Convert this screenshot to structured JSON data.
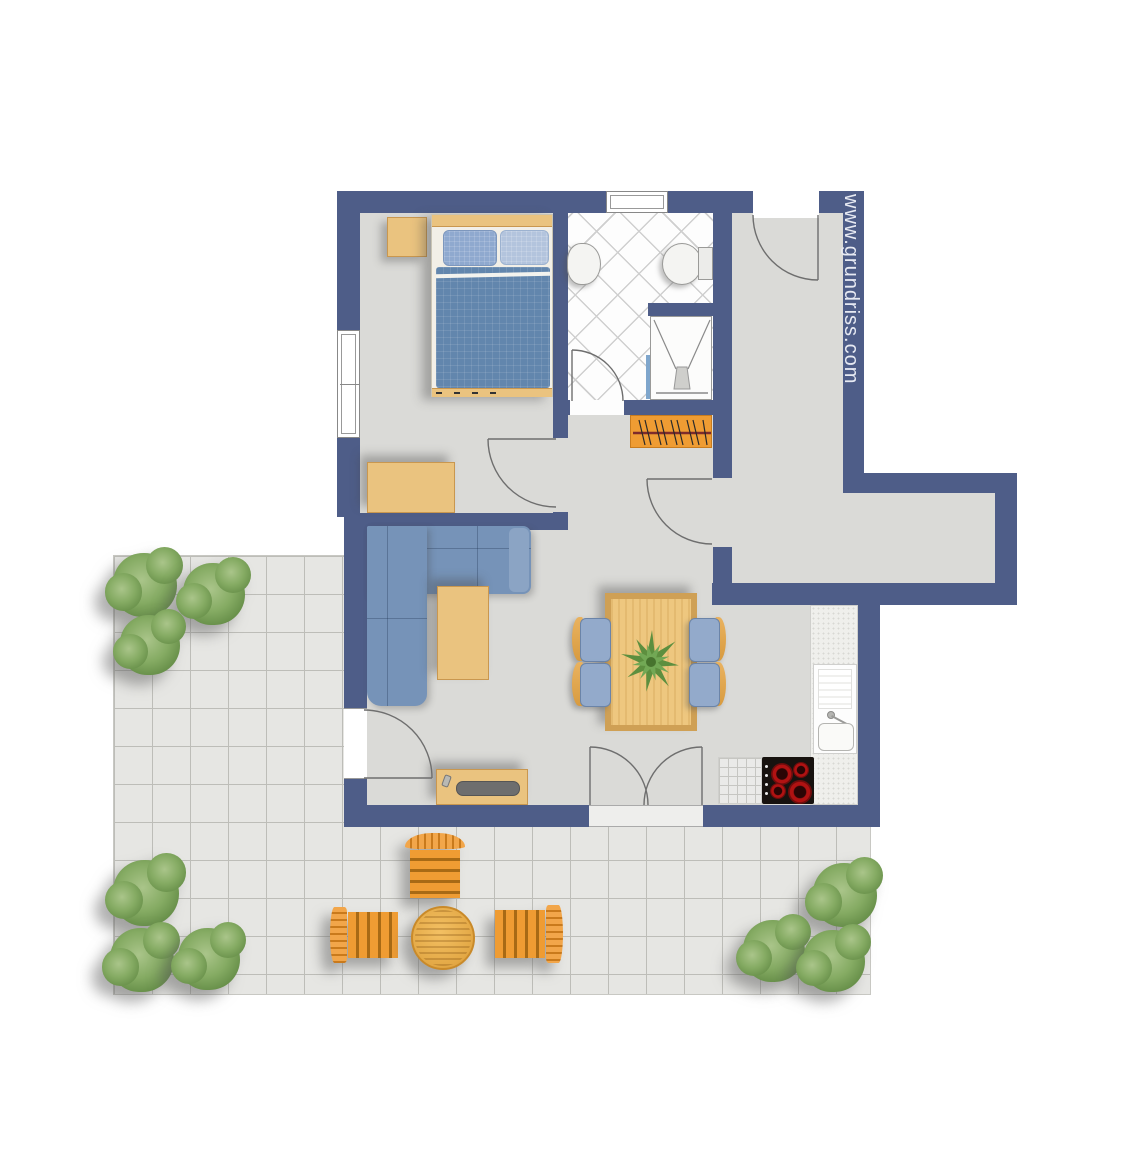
{
  "watermark": {
    "text": "www.grundriss.com"
  },
  "palette": {
    "wall": "#4e5d88",
    "floor": "#dadad7",
    "terrace_tile": "#e6e6e3",
    "tile_line": "#bdbdb8",
    "wood": "#eac37f",
    "wood_dark": "#c9974f",
    "table_wood": "#eec77f",
    "table_border": "#cfa055",
    "sofa": "#7693b8",
    "sofa_light": "#8ba4c4",
    "bed_blanket": "#6286ad",
    "pillow_dark": "#8fa9cf",
    "pillow_light": "#b3c4dd",
    "chair_seat": "#93aacb",
    "chair_back": "#e9b25f",
    "orange": "#ef9c33",
    "bush_green": "#7ba05b",
    "plant_green": "#5d8f3f",
    "cooktop": "#17120f",
    "burner": "#b01212",
    "glass": "#7fa6cc",
    "watermark_color": "#e7eaf3"
  },
  "rooms": [
    "bedroom",
    "bathroom",
    "hall",
    "corridor",
    "living-dining",
    "kitchen",
    "terrace"
  ],
  "furniture": [
    "double-bed",
    "nightstand",
    "dresser",
    "wardrobe",
    "washbasin",
    "toilet",
    "shower",
    "corner-sofa",
    "coffee-table",
    "tv-board",
    "dining-table",
    "dining-chairs",
    "kitchen-sink",
    "cooktop",
    "terrace-table",
    "terrace-chairs",
    "bushes"
  ],
  "dining": {
    "chairs": [
      {
        "x": 572,
        "y": 617,
        "side": "side-left"
      },
      {
        "x": 572,
        "y": 662,
        "side": "side-left"
      },
      {
        "x": 690,
        "y": 617,
        "side": "side-right"
      },
      {
        "x": 690,
        "y": 662,
        "side": "side-right"
      }
    ]
  },
  "terrace": {
    "bushes": [
      {
        "x": 113,
        "y": 553,
        "d": 64
      },
      {
        "x": 183,
        "y": 563,
        "d": 62
      },
      {
        "x": 120,
        "y": 615,
        "d": 60
      },
      {
        "x": 113,
        "y": 860,
        "d": 66
      },
      {
        "x": 110,
        "y": 928,
        "d": 64
      },
      {
        "x": 178,
        "y": 928,
        "d": 62
      },
      {
        "x": 813,
        "y": 863,
        "d": 64
      },
      {
        "x": 743,
        "y": 920,
        "d": 62
      },
      {
        "x": 803,
        "y": 930,
        "d": 62
      }
    ],
    "chairs": [
      {
        "x": 405,
        "y": 833,
        "w": 60,
        "h": 65,
        "type": "tc-top"
      },
      {
        "x": 330,
        "y": 907,
        "w": 68,
        "h": 56,
        "type": "tc-left"
      },
      {
        "x": 495,
        "y": 905,
        "w": 68,
        "h": 58,
        "type": "tc-right"
      }
    ],
    "table": {
      "x": 411,
      "y": 906,
      "d": 60
    }
  },
  "kitchen": {
    "burners": [
      {
        "cx": 20,
        "cy": 17,
        "r": 11
      },
      {
        "cx": 39,
        "cy": 13,
        "r": 8
      },
      {
        "cx": 16,
        "cy": 34,
        "r": 8
      },
      {
        "cx": 38,
        "cy": 35,
        "r": 12
      }
    ],
    "knobs_y": [
      8,
      17,
      26,
      35
    ]
  }
}
